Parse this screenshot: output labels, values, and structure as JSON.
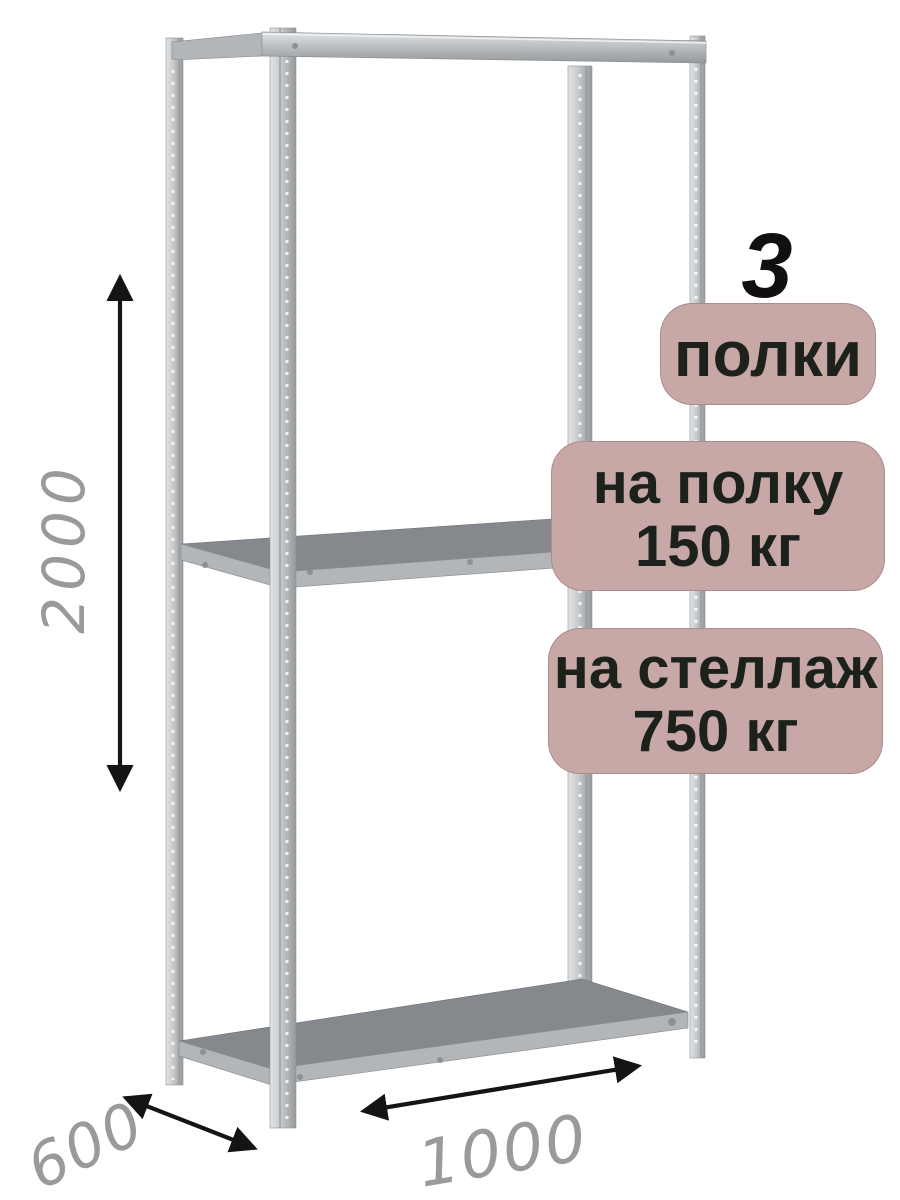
{
  "badges": {
    "shelves": {
      "count": "3",
      "label": "полки"
    },
    "shelf_load": {
      "line1": "на полку",
      "line2": "150 кг"
    },
    "rack_load": {
      "line1": "на стеллаж",
      "line2": "750 кг"
    }
  },
  "dimensions": {
    "height": "2000",
    "depth": "600",
    "width": "1000"
  },
  "colors": {
    "badge_bg": "#c7a8a6",
    "badge_text": "#1d211b",
    "count_text": "#101010",
    "dimension_text": "#9a9a9a",
    "arrow": "#141414",
    "metal_light": "#e3e5e6",
    "metal": "#c5c8cb",
    "metal_dark": "#96999c",
    "shelf_surface": "#85898d",
    "shelf_edge": "#b2b6b9",
    "holes": "#f2f3f4"
  }
}
